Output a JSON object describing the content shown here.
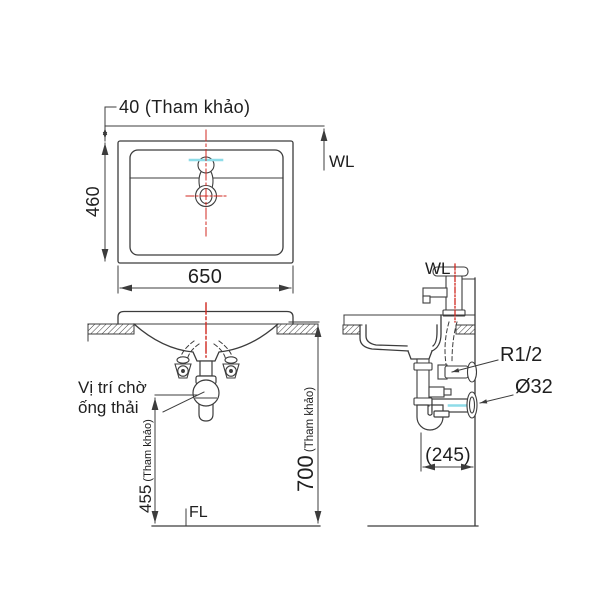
{
  "colors": {
    "line": "#3c3c3c",
    "text": "#1f1f1f",
    "centerline": "#d02820",
    "water": "#8edce8",
    "bg": "#ffffff"
  },
  "plan": {
    "dim_top": "40 (Tham khảo)",
    "wl": "WL",
    "dim_left": "460",
    "dim_bottom": "650"
  },
  "front": {
    "note1": "Vị trí chờ",
    "note2": "ống thải",
    "dim_left_main": "455",
    "dim_left_note": " (Tham khảo)",
    "floor": "FL",
    "dim_right_main": "700",
    "dim_right_note": " (Tham khảo)"
  },
  "side": {
    "wl": "WL",
    "supply": "R1/2",
    "drain": "Ø32",
    "dim_bottom": "(245)"
  }
}
